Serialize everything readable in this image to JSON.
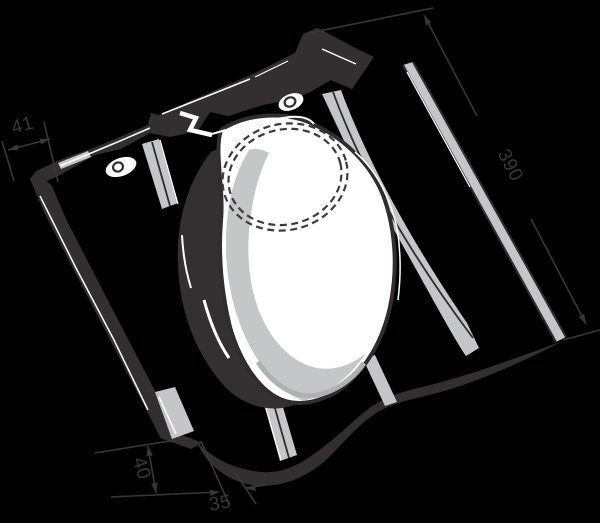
{
  "meta": {
    "title": "Roof tile with vent cowl - technical line drawing",
    "type": "technical-illustration"
  },
  "dimension_labels": {
    "interlock_width": "41",
    "tile_length": "390",
    "front_edge_height": "40",
    "front_edge_offset": "35"
  },
  "colors": {
    "background": "#000000",
    "dimension_line": "#3a3637",
    "outline_dark": "#312d2e",
    "band_dark": "#332f30",
    "shadow_dark": "#343031",
    "rib_gray": "#c5c6c8",
    "rim_gray": "#b0b1b3",
    "cap_white": "#ffffff",
    "highlight_white": "#ffffff",
    "dashed_line": "#3f3b3c"
  }
}
